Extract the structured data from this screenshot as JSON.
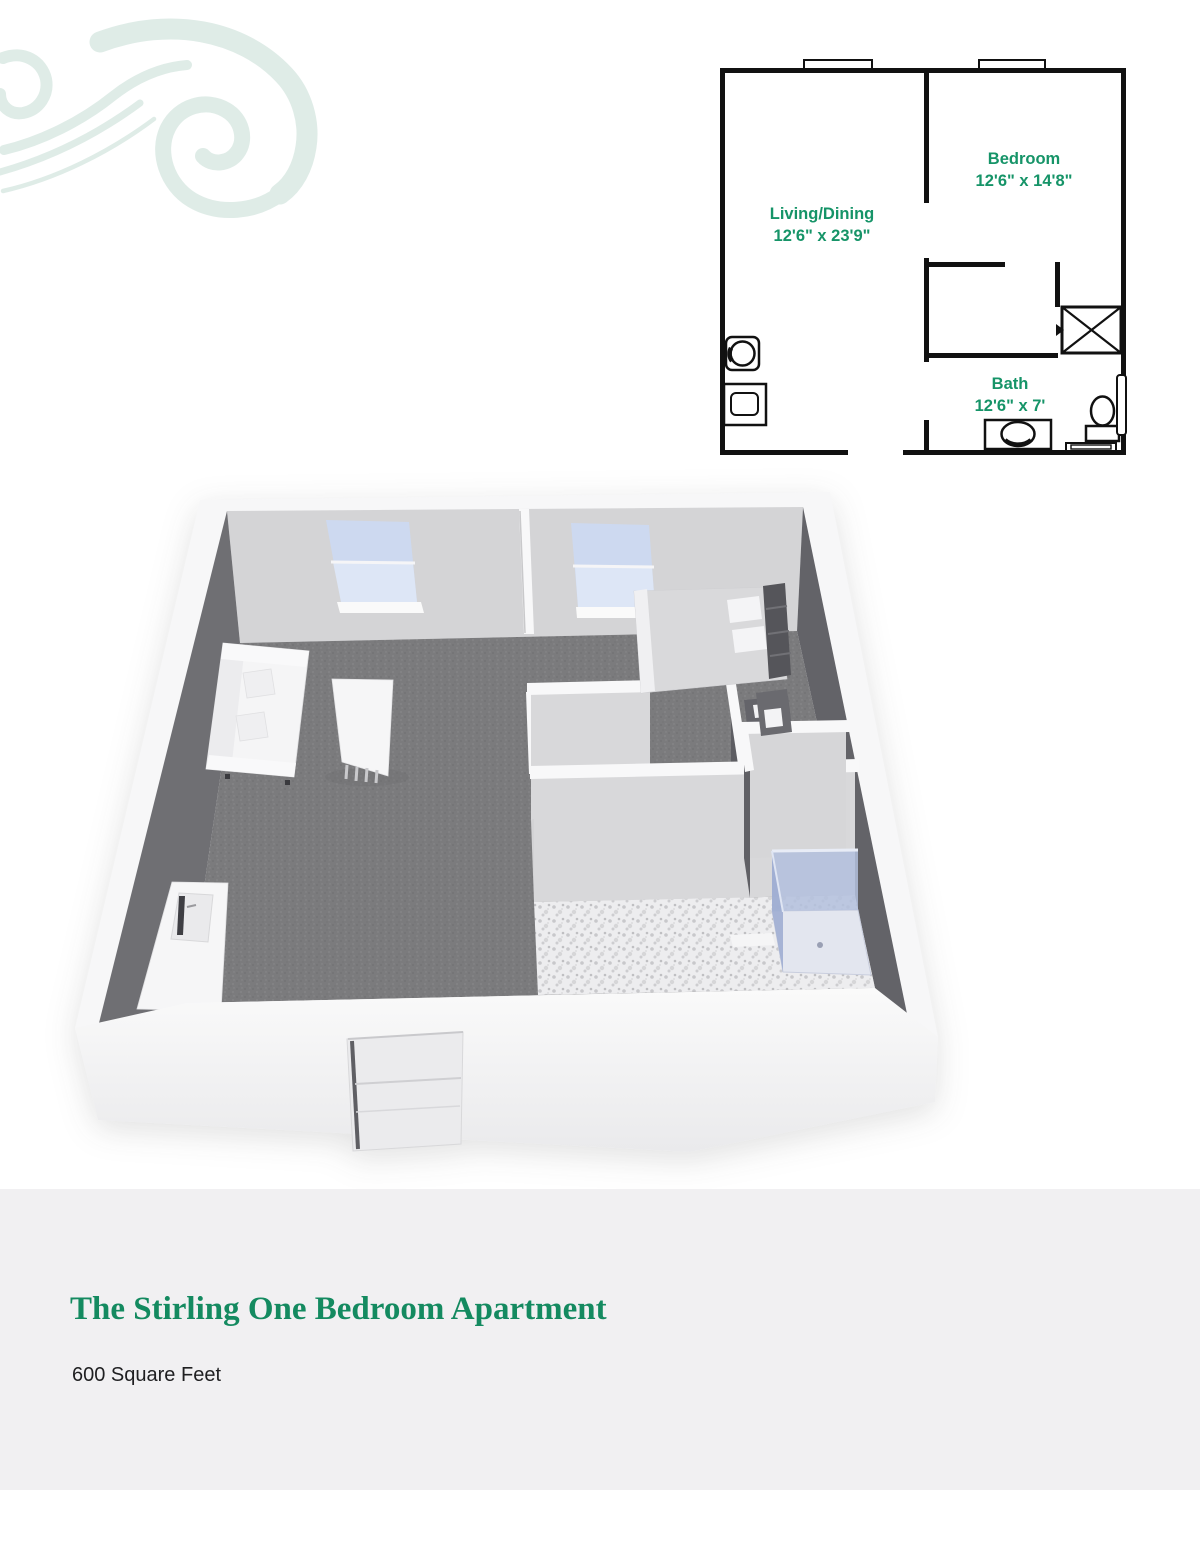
{
  "floor_plan": {
    "label_color": "#169468",
    "wall_color": "#111111",
    "rooms": [
      {
        "id": "living",
        "name": "Living/Dining",
        "dimensions": "12'6\" x 23'9\""
      },
      {
        "id": "bedroom",
        "name": "Bedroom",
        "dimensions": "12'6\" x 14'8\""
      },
      {
        "id": "bath",
        "name": "Bath",
        "dimensions": "12'6\" x 7'"
      }
    ],
    "symbols": [
      "window",
      "washer",
      "laundry-sink",
      "closet",
      "vanity-sink",
      "toilet",
      "bath-mat",
      "shower-glass"
    ]
  },
  "render_3d": {
    "palette": {
      "outer_wall": "#f7f7f8",
      "interior_wall_light": "#d6d6d8",
      "interior_wall_dark": "#66666b",
      "carpet": "#7b7b7d",
      "tile": "#ededef",
      "window_glass": "#cdd9f0",
      "shower_glass": "#a9b6d8",
      "furniture": "#f5f5f6",
      "bed": "#d9d9db",
      "headboard": "#55555a"
    }
  },
  "watermark": {
    "color": "#dceae5"
  },
  "footer": {
    "title": "The Stirling One Bedroom Apartment",
    "subtitle": "600 Square Feet",
    "title_color": "#148a60",
    "subtitle_color": "#1f1f21",
    "background": "#f1f0f2"
  }
}
